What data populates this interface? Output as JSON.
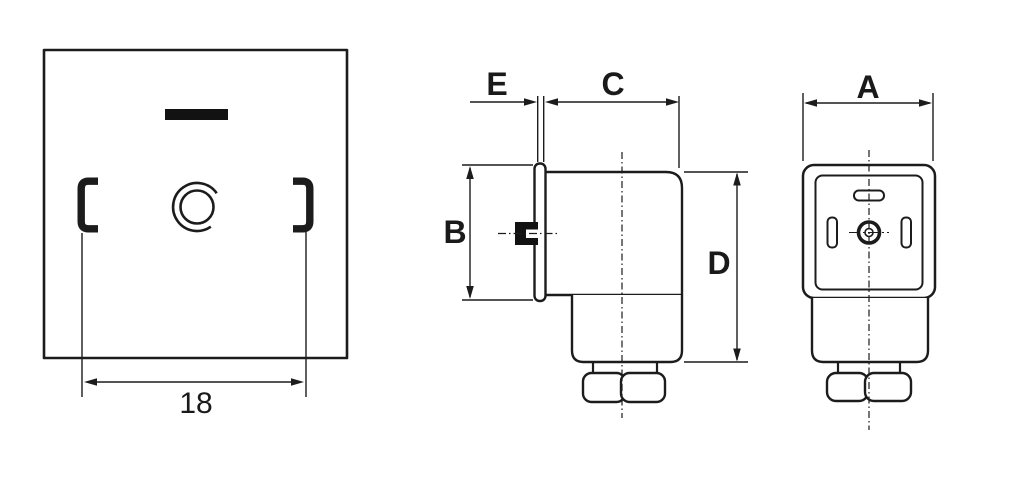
{
  "drawing": {
    "background_color": "#ffffff",
    "line_color": "#1c1c1c",
    "front_view": {
      "width_dim": "18"
    },
    "side_view": {
      "dim_e": "E",
      "dim_c": "C",
      "dim_b": "B",
      "dim_d": "D"
    },
    "face_view": {
      "dim_a": "A"
    }
  }
}
